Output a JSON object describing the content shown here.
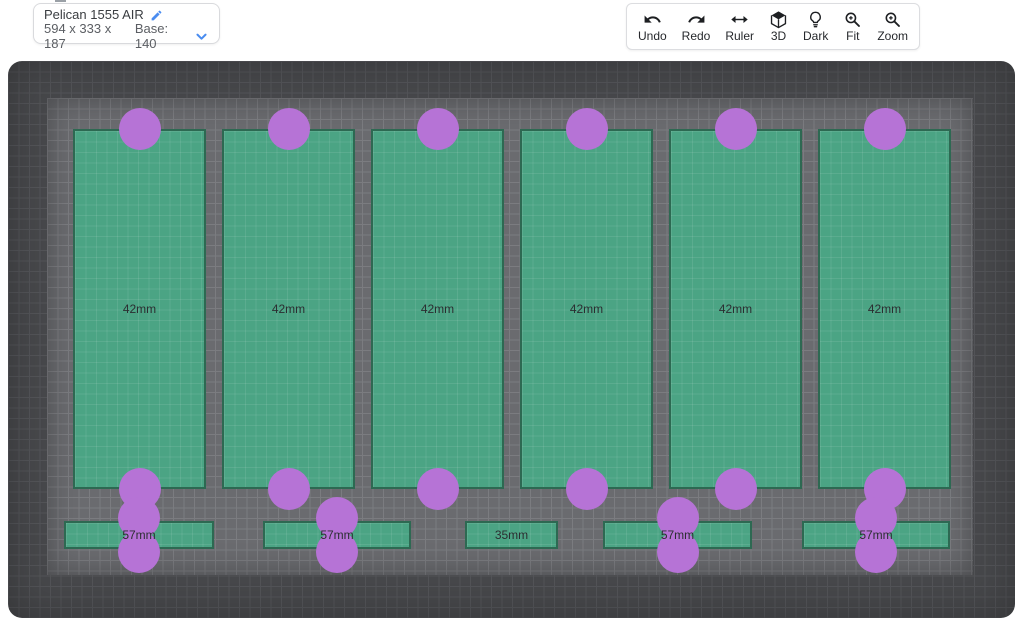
{
  "info_card": {
    "title": "Pelican 1555 AIR",
    "dimensions": "594 x 333 x 187",
    "base_label": "Base: 140",
    "accent_color": "#4a8cf0"
  },
  "toolbar": {
    "items": [
      {
        "label": "Undo",
        "icon": "undo-icon"
      },
      {
        "label": "Redo",
        "icon": "redo-icon"
      },
      {
        "label": "Ruler",
        "icon": "ruler-icon"
      },
      {
        "label": "3D",
        "icon": "cube-3d-icon"
      },
      {
        "label": "Dark",
        "icon": "lightbulb-icon"
      },
      {
        "label": "Fit",
        "icon": "zoom-fit-icon"
      },
      {
        "label": "Zoom",
        "icon": "zoom-in-icon"
      }
    ]
  },
  "canvas": {
    "colors": {
      "canvas_bg": "#47484b",
      "canvas_grid": "#535458",
      "foam_bg": "#6a6b6f",
      "foam_grid": "#7b7c80",
      "pocket_fill": "#4ba484",
      "pocket_border": "#2d6952",
      "hole_fill": "#b673d6",
      "label_color": "#2b2e31"
    },
    "pockets": [
      {
        "label": "42mm",
        "x": 65,
        "y": 68,
        "w": 133,
        "h": 360
      },
      {
        "label": "42mm",
        "x": 214,
        "y": 68,
        "w": 133,
        "h": 360
      },
      {
        "label": "42mm",
        "x": 363,
        "y": 68,
        "w": 133,
        "h": 360
      },
      {
        "label": "42mm",
        "x": 512,
        "y": 68,
        "w": 133,
        "h": 360
      },
      {
        "label": "42mm",
        "x": 661,
        "y": 68,
        "w": 133,
        "h": 360
      },
      {
        "label": "42mm",
        "x": 810,
        "y": 68,
        "w": 133,
        "h": 360
      },
      {
        "label": "57mm",
        "x": 56,
        "y": 460,
        "w": 150,
        "h": 28
      },
      {
        "label": "57mm",
        "x": 255,
        "y": 460,
        "w": 148,
        "h": 28
      },
      {
        "label": "35mm",
        "x": 457,
        "y": 460,
        "w": 93,
        "h": 28
      },
      {
        "label": "57mm",
        "x": 595,
        "y": 460,
        "w": 149,
        "h": 28
      },
      {
        "label": "57mm",
        "x": 794,
        "y": 460,
        "w": 148,
        "h": 28
      }
    ],
    "holes": [
      {
        "cx": 131.5,
        "cy": 68
      },
      {
        "cx": 280.5,
        "cy": 68
      },
      {
        "cx": 429.5,
        "cy": 68
      },
      {
        "cx": 578.5,
        "cy": 68
      },
      {
        "cx": 727.5,
        "cy": 68
      },
      {
        "cx": 876.5,
        "cy": 68
      },
      {
        "cx": 131.5,
        "cy": 428
      },
      {
        "cx": 280.5,
        "cy": 428
      },
      {
        "cx": 429.5,
        "cy": 428
      },
      {
        "cx": 578.5,
        "cy": 428
      },
      {
        "cx": 727.5,
        "cy": 428
      },
      {
        "cx": 876.5,
        "cy": 428
      },
      {
        "cx": 131,
        "cy": 457
      },
      {
        "cx": 131,
        "cy": 491
      },
      {
        "cx": 329,
        "cy": 457
      },
      {
        "cx": 329,
        "cy": 491
      },
      {
        "cx": 669.5,
        "cy": 457
      },
      {
        "cx": 669.5,
        "cy": 491
      },
      {
        "cx": 868,
        "cy": 457
      },
      {
        "cx": 868,
        "cy": 491
      }
    ],
    "hole_radius": 21
  }
}
